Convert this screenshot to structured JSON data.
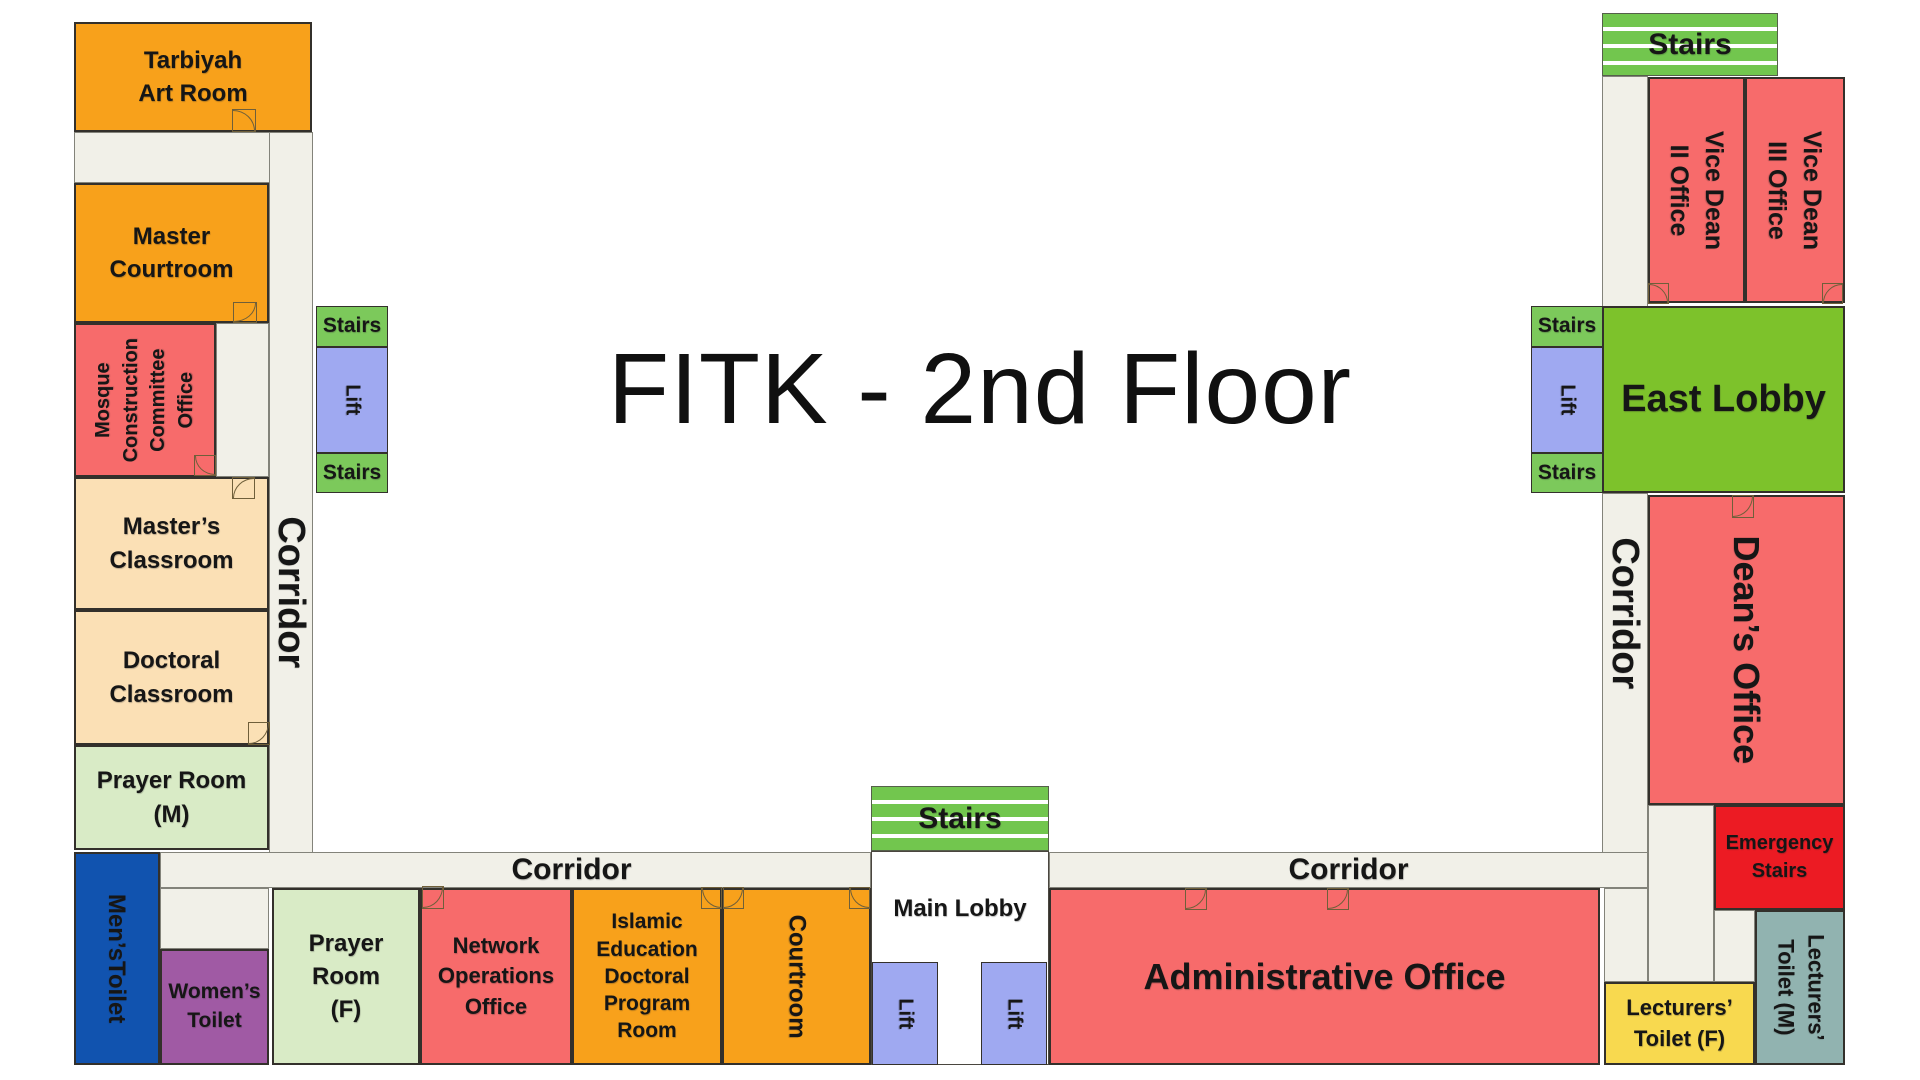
{
  "title": "FITK - 2nd Floor",
  "circulation": {
    "corridor": "Corridor",
    "stairs": "Stairs",
    "lift": "Lift",
    "main_lobby": "Main Lobby",
    "east_lobby": "East Lobby",
    "emergency_stairs": "Emergency\nStairs"
  },
  "rooms": {
    "tarbiyah_art_room": "Tarbiyah\nArt Room",
    "master_courtroom": "Master\nCourtroom",
    "mosque_construction_committee_office": "Mosque\nConstruction\nCommittee\nOffice",
    "masters_classroom": "Master’s\nClassroom",
    "doctoral_classroom": "Doctoral\nClassroom",
    "prayer_room_m": "Prayer Room\n(M)",
    "mens_toilet": "Men’sToilet",
    "womens_toilet": "Women’s\nToilet",
    "prayer_room_f": "Prayer\nRoom\n(F)",
    "network_operations_office": "Network\nOperations\nOffice",
    "islamic_education_doctoral_program_room": "Islamic\nEducation\nDoctoral\nProgram\nRoom",
    "courtroom": "Courtroom",
    "administrative_office": "Administrative Office",
    "deans_office": "Dean’s Office",
    "vice_dean_ii_office": "Vice Dean\nII Office",
    "vice_dean_iii_office": "Vice Dean\nIII Office",
    "lecturers_toilet_f": "Lecturers’\nToilet (F)",
    "lecturers_toilet_m": "Lecturers’\nToilet (M)"
  },
  "colors": {
    "room_orange": "#F8A11B",
    "room_red": "#F76B6B",
    "room_peach": "#FBE0B5",
    "prayer_green": "#D9EBC6",
    "mens_toilet_blue": "#1153AF",
    "womens_toilet_purple": "#A05AA4",
    "lift_periwinkle": "#9FA9F1",
    "stairs_green_striped": "#72C64E",
    "stairs_green_small": "#7CC95B",
    "east_lobby_green": "#7DC22B",
    "corridor_floor": "#F1F0E8",
    "emergency_stairs_red": "#EC1B23",
    "lecturers_toilet_f_yellow": "#F8D94F",
    "lecturers_toilet_m_teal": "#91B3B0"
  }
}
